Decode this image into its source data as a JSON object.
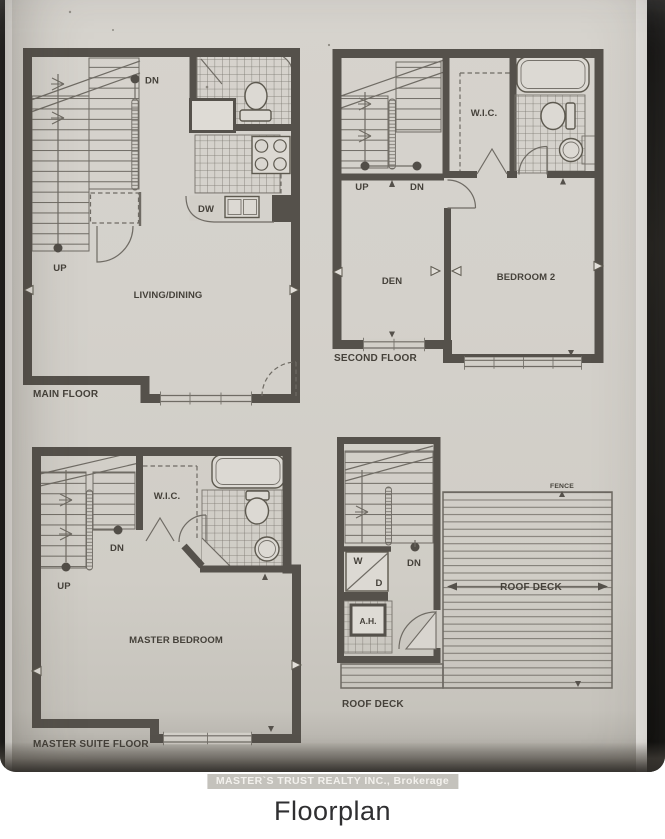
{
  "caption": "Floorplan",
  "photo": {
    "watermark": "MASTER`S TRUST REALTY INC., Brokerage"
  },
  "colors": {
    "paper": "#d2cfc8",
    "wall": "#55514b",
    "thin_line": "#6f6b64",
    "label_text": "#45413a",
    "watermark_band": "#bab7b0",
    "caption_text": "#2f2f31"
  },
  "plans": {
    "main_floor": {
      "name": "MAIN FLOOR",
      "living_dining": "LIVING/DINING",
      "dishwasher": "DW",
      "up": "UP",
      "down": "DN"
    },
    "second_floor": {
      "name": "SECOND FLOOR",
      "den": "DEN",
      "bedroom2": "BEDROOM 2",
      "wic": "W.I.C.",
      "up": "UP",
      "down": "DN"
    },
    "master_suite": {
      "name": "MASTER SUITE FLOOR",
      "master_bedroom": "MASTER BEDROOM",
      "wic": "W.I.C.",
      "up": "UP",
      "down": "DN"
    },
    "roof_deck": {
      "name": "ROOF DECK",
      "deck": "ROOF DECK",
      "fence": "FENCE",
      "washer": "W",
      "dryer": "D",
      "air_handler": "A.H.",
      "down": "DN"
    }
  }
}
